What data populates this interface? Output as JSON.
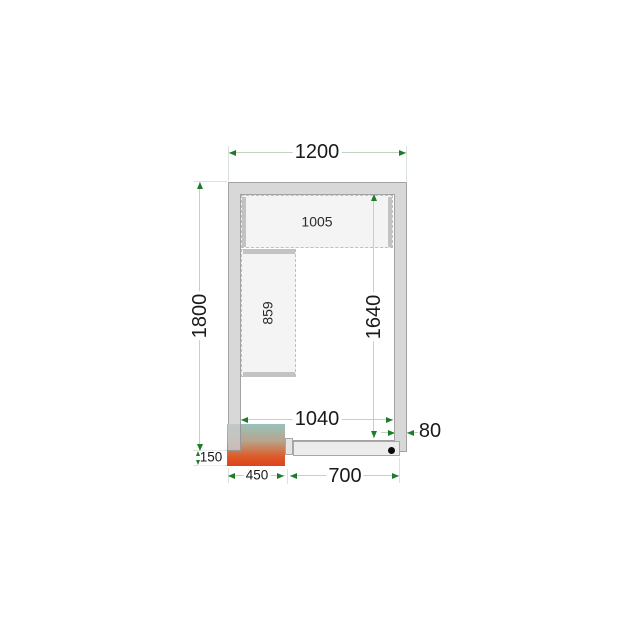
{
  "title": "Cold room floor plan with shelving and cooling unit",
  "colors": {
    "wall_fill": "#d8d8d8",
    "wall_border": "#a2a2a2",
    "shelf_fill": "#f4f4f4",
    "dimension_line": "#c3d3c3",
    "arrowhead": "#1e7b2c",
    "text": "#1a1a1a",
    "unit_gradient_cold": "#97c3bc",
    "unit_gradient_hot": "#dc431b",
    "hinge_dot": "#0a0a0a"
  },
  "dimensions": {
    "outer_width": "1200",
    "outer_depth": "1800",
    "inner_width": "1040",
    "inner_depth": "1640",
    "wall_thickness": "80",
    "unit_protrusion": "150",
    "unit_width": "450",
    "door_section_width": "700",
    "top_shelf_length": "1005",
    "side_shelf_length": "859"
  }
}
